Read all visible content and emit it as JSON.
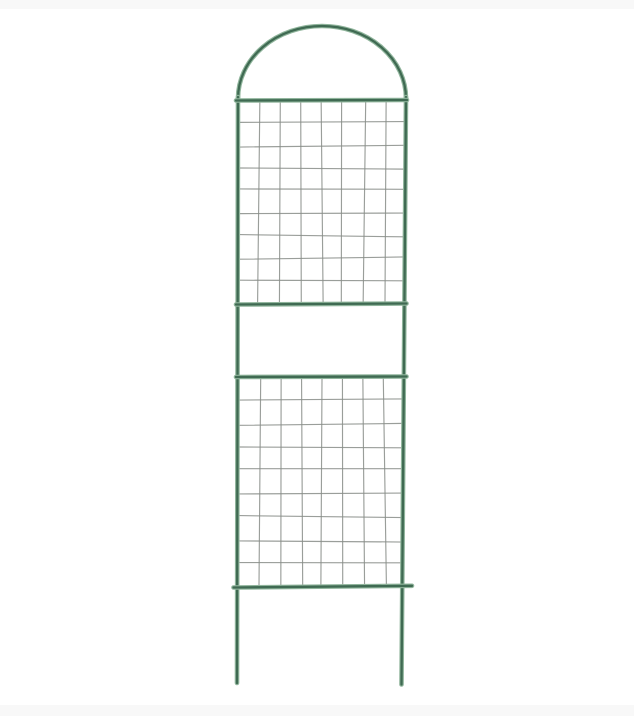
{
  "scene": {
    "kind": "product-photo",
    "alt": "Green metal garden trellis with an arched top, two welded-wire mesh panels separated by an open band, and two ground-stake legs, photographed on a white background",
    "canvas": {
      "width": 634,
      "height": 716
    },
    "background_color": "#ffffff",
    "bands": {
      "top": {
        "y": 0,
        "height": 9,
        "color": "#f8f8f8"
      },
      "bottom": {
        "y": 705,
        "height": 11,
        "color": "#f8f8f8"
      }
    },
    "trellis": {
      "frame_color_core": "#3f6a52",
      "frame_color_edge": "#8fb49b",
      "frame_width": 4.6,
      "frame_core_width": 2.3,
      "wire_color": "#888d88",
      "wire_width": 1.15,
      "wire_opacity": 0.85,
      "geometry": {
        "arch": {
          "cx": 322,
          "rx": 84,
          "ry": 72.5,
          "base_y": 98.5,
          "apex_y": 26
        },
        "left_rail": {
          "x_top": 238,
          "y_top": 97,
          "x_bottom": 237,
          "y_bottom": 683
        },
        "right_rail": {
          "x_top": 406,
          "y_top": 97,
          "x_bottom": 401.5,
          "y_bottom": 684.5
        },
        "bars": [
          {
            "x1": 236,
            "y1": 100.5,
            "x2": 407,
            "y2": 100
          },
          {
            "x1": 236,
            "y1": 304.5,
            "x2": 406.5,
            "y2": 303.5
          },
          {
            "x1": 236,
            "y1": 377,
            "x2": 406.5,
            "y2": 376.5
          },
          {
            "x1": 233.5,
            "y1": 587.5,
            "x2": 412,
            "y2": 585.8
          }
        ],
        "panels": [
          {
            "x1": 238,
            "x2": 406,
            "y1": 100,
            "y2": 304,
            "columns": 8,
            "rows": 9
          },
          {
            "x1": 238,
            "x2": 406,
            "y1": 377,
            "y2": 587,
            "columns": 8,
            "rows": 9
          }
        ]
      }
    }
  }
}
